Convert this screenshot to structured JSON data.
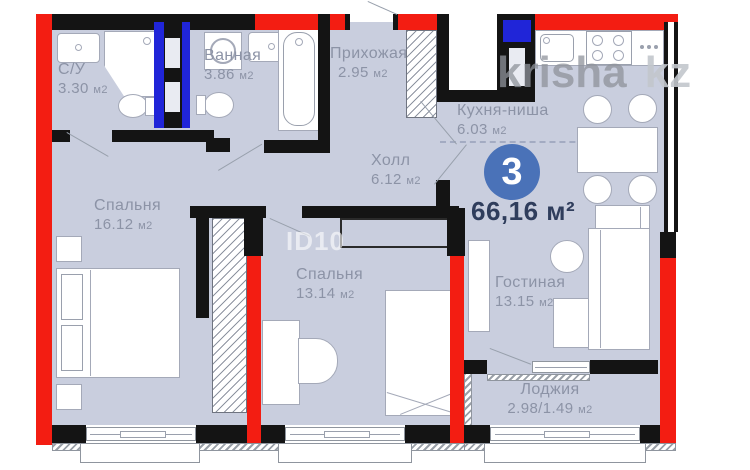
{
  "watermark": {
    "brand": "krisha",
    "tld": "kz",
    "listing_id": "ID10"
  },
  "summary": {
    "room_count": "3",
    "total_area": "66,16 м²"
  },
  "rooms": [
    {
      "name": "С/У",
      "area": "3.30",
      "unit": "м2"
    },
    {
      "name": "Ванная",
      "area": "3.86",
      "unit": "м2"
    },
    {
      "name": "Прихожая",
      "area": "2.95",
      "unit": "м2"
    },
    {
      "name": "Кухня-ниша",
      "area": "6.03",
      "unit": "м2"
    },
    {
      "name": "Холл",
      "area": "6.12",
      "unit": "м2"
    },
    {
      "name": "Спальня",
      "area": "16.12",
      "unit": "м2"
    },
    {
      "name": "Спальня",
      "area": "13.14",
      "unit": "м2"
    },
    {
      "name": "Гостиная",
      "area": "13.15",
      "unit": "м2"
    },
    {
      "name": "Лоджия",
      "area": "2.98/1.49",
      "unit": "м2"
    }
  ],
  "colors": {
    "wall_red": "#f31d12",
    "wall_black": "#141414",
    "shaft_blue": "#2025d8",
    "floor": "#c9cede",
    "badge": "#4a72b8",
    "label_text": "#8c93a6",
    "total_text": "#2f3d5c"
  }
}
